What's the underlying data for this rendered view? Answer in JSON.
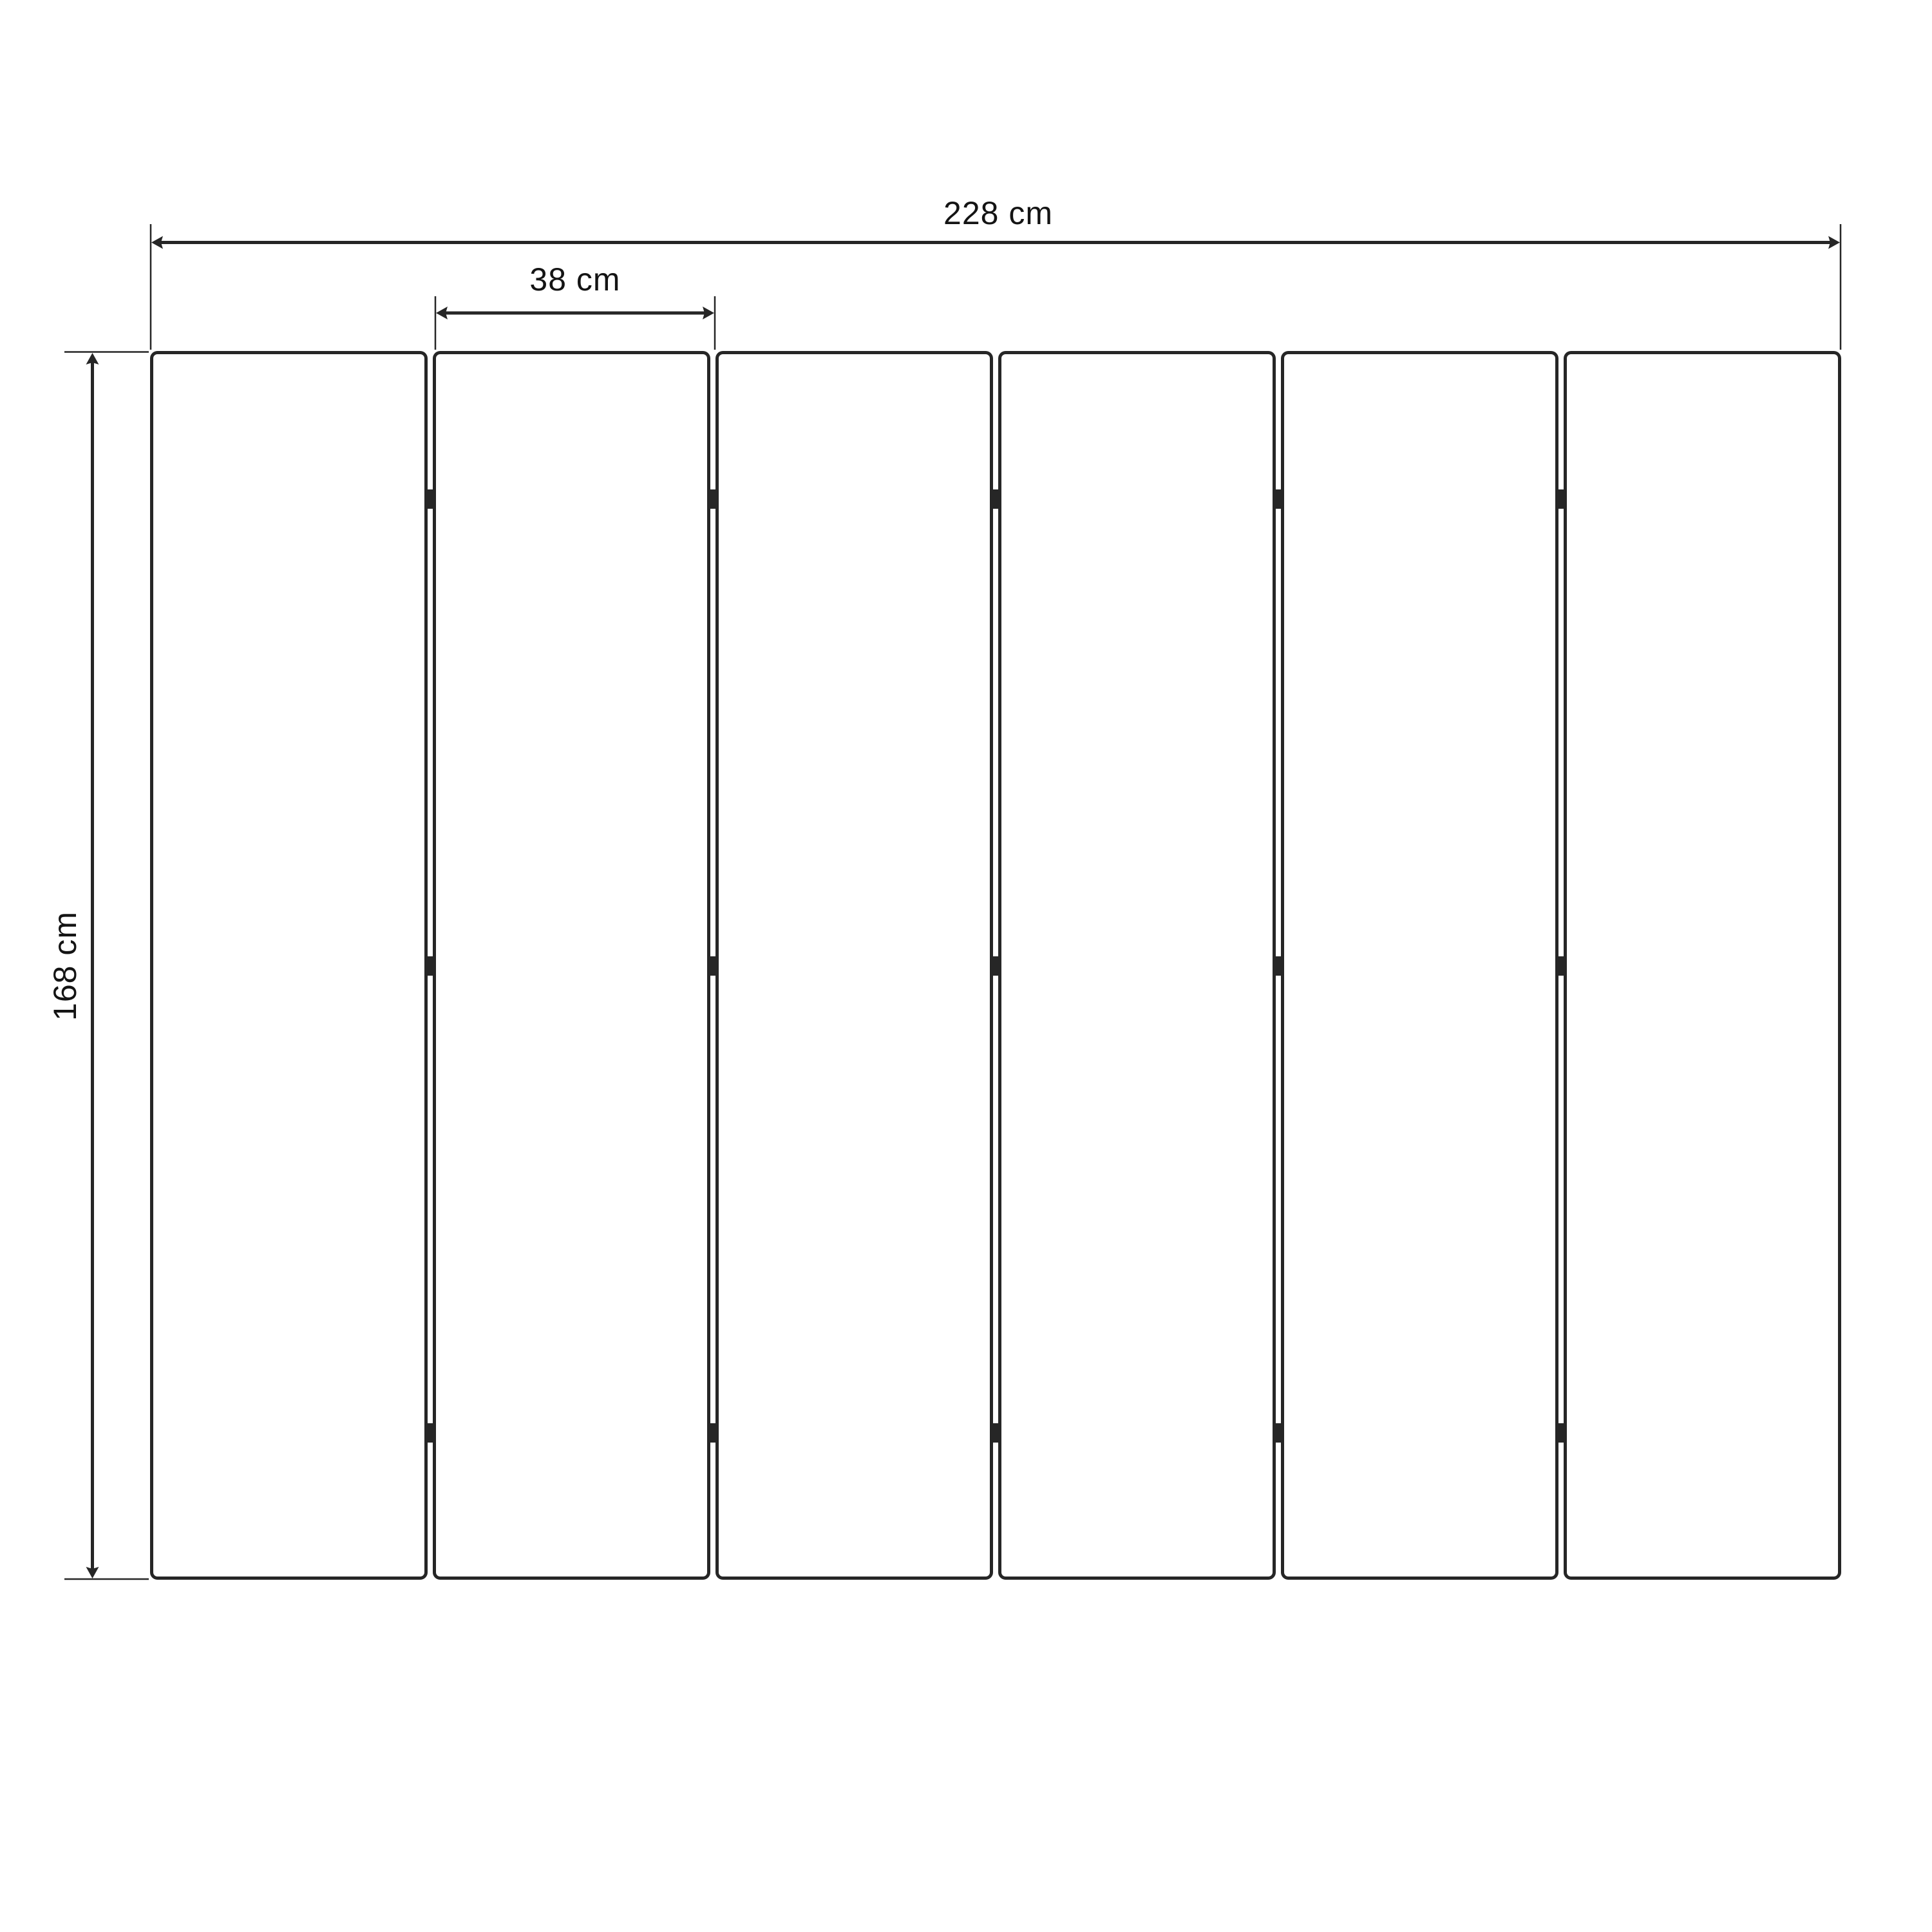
{
  "figure": {
    "background": "#ffffff",
    "line_color": "#262626",
    "text_color": "#141414",
    "panel_count": 6,
    "hinge_rows": 3,
    "labels": {
      "total_width": "228 cm",
      "panel_width": "38 cm",
      "panel_height": "168 cm"
    }
  }
}
